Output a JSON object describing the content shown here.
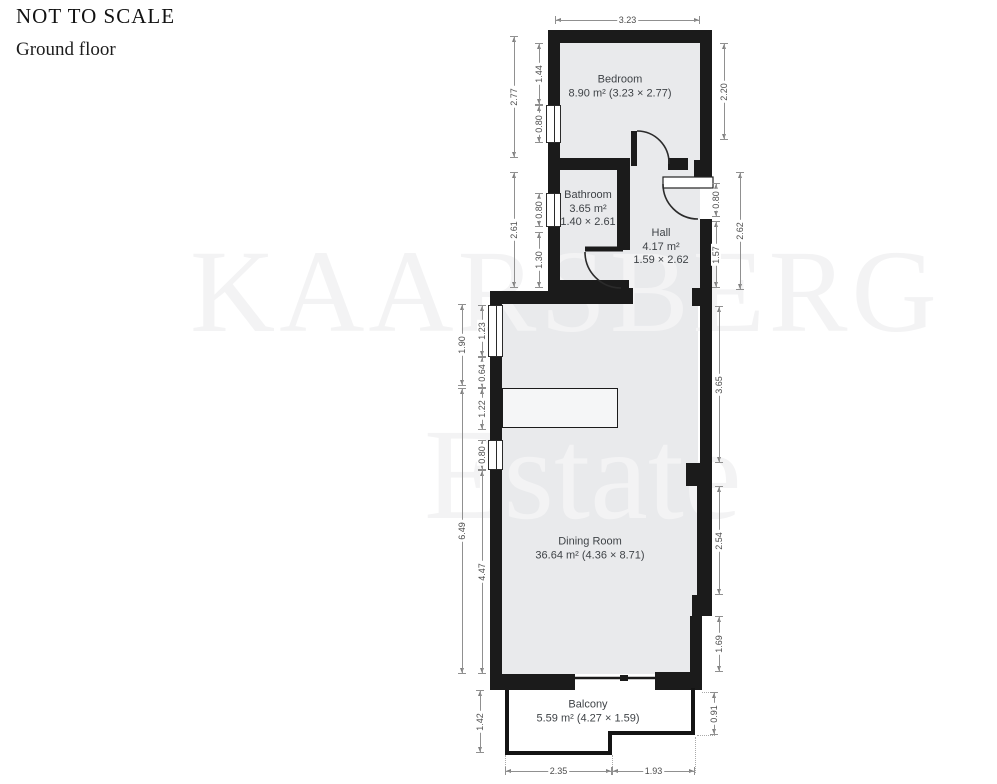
{
  "header": {
    "title": "NOT TO SCALE",
    "subtitle": "Ground floor"
  },
  "watermark": {
    "line1": "KAARSBERG",
    "line2": "Estate"
  },
  "rooms": {
    "bedroom": {
      "lines": [
        "Bedroom",
        "8.90 m² (3.23 × 2.77)"
      ]
    },
    "bathroom": {
      "lines": [
        "Bathroom",
        "3.65 m²",
        "1.40 × 2.61"
      ]
    },
    "hall": {
      "lines": [
        "Hall",
        "4.17 m²",
        "1.59 × 2.62"
      ]
    },
    "dining_room": {
      "lines": [
        "Dining Room",
        "36.64 m² (4.36 × 8.71)"
      ]
    },
    "balcony": {
      "lines": [
        "Balcony",
        "5.59 m² (4.27 × 1.59)"
      ]
    }
  },
  "dimensions": {
    "bedroom": {
      "top": "3.23",
      "left_total": "2.77",
      "left_upper": "1.44",
      "left_window": "0.80",
      "right": "2.20"
    },
    "bathroom": {
      "left_total": "2.61",
      "left_window": "0.80",
      "left_lower": "1.30"
    },
    "hall": {
      "right_door": "0.80",
      "right_total": "2.62",
      "right_lower": "1.57"
    },
    "dining": {
      "left_upper_total": "1.90",
      "left_window1": "1.23",
      "left_wall": "0.64",
      "left_counter": "1.22",
      "left_window2": "0.80",
      "left_total": "6.49",
      "left_lower": "4.47",
      "right_upper": "3.65",
      "right_mid": "2.54",
      "right_lower": "1.69"
    },
    "balcony": {
      "left": "1.42",
      "right": "0.91",
      "bottom_left": "2.35",
      "bottom_right": "1.93"
    }
  },
  "colors": {
    "floor": "#e9eaec",
    "wall": "#1b1b1b",
    "dim_line": "#909090",
    "dim_text": "#4d4d4d",
    "label_text": "#3f4347",
    "watermark": "#f3f3f4"
  }
}
